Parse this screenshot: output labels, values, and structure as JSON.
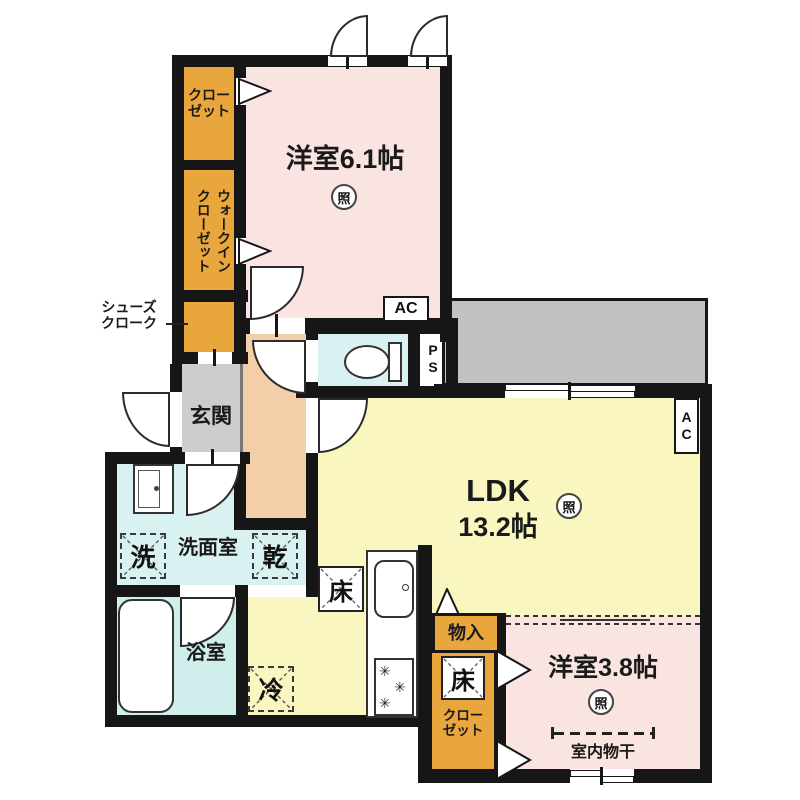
{
  "rooms": {
    "bedroom_61": "洋室6.1帖",
    "ldk_name": "LDK",
    "ldk_size": "13.2帖",
    "bedroom_38": "洋室3.8帖",
    "genkan": "玄関",
    "washroom": "洗面室",
    "bathroom": "浴室",
    "closet_top": "クロー\nゼット",
    "wic_col1": "ウォークイン",
    "wic_col2": "クローゼット",
    "shoe_cloak": "シューズ\nクローク",
    "storage": "物入",
    "closet_bottom": "クロー\nゼット"
  },
  "marks": {
    "washer": "洗",
    "dryer": "乾",
    "fridge": "冷",
    "floor_hatch_kitchen": "床",
    "floor_hatch_closet": "床",
    "light": "照",
    "ac_bedroom": "AC",
    "ac_ldk": "AC",
    "pipe_space": "PS",
    "indoor_drying": "室内物干"
  },
  "colors": {
    "wall": "#161616",
    "room_pink": "#F9E4E1",
    "room_yellow": "#FAF6C0",
    "closet_orange": "#E9A63C",
    "corridor_beige": "#F3CFA9",
    "genkan_gray": "#CDCDCD",
    "wet_cyan": "#D9F2F1",
    "bath_cyan": "#CFEEEC",
    "balcony_gray": "#C2C2C2"
  }
}
